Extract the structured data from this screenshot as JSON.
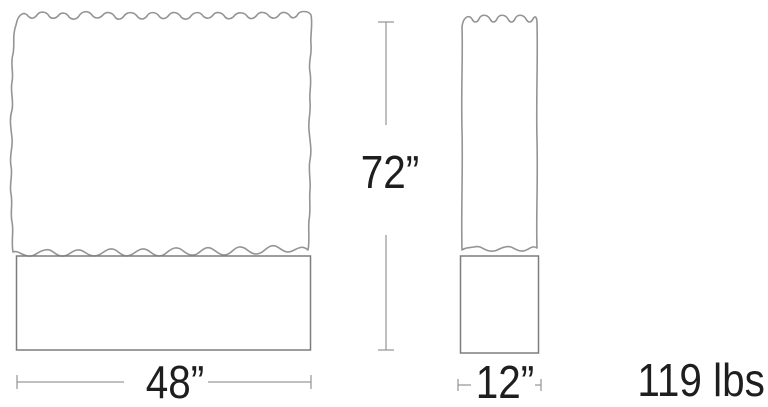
{
  "figure": {
    "height_label": "72”",
    "front_view": {
      "width_label": "48”"
    },
    "side_view": {
      "depth_label": "12”"
    },
    "weight_label": "119 lbs"
  },
  "colors": {
    "background": "#ffffff",
    "outline": "#949494",
    "base-outline": "#7d7d7d",
    "dimension": "#9a9a9a",
    "text": "#1e1e1e"
  }
}
